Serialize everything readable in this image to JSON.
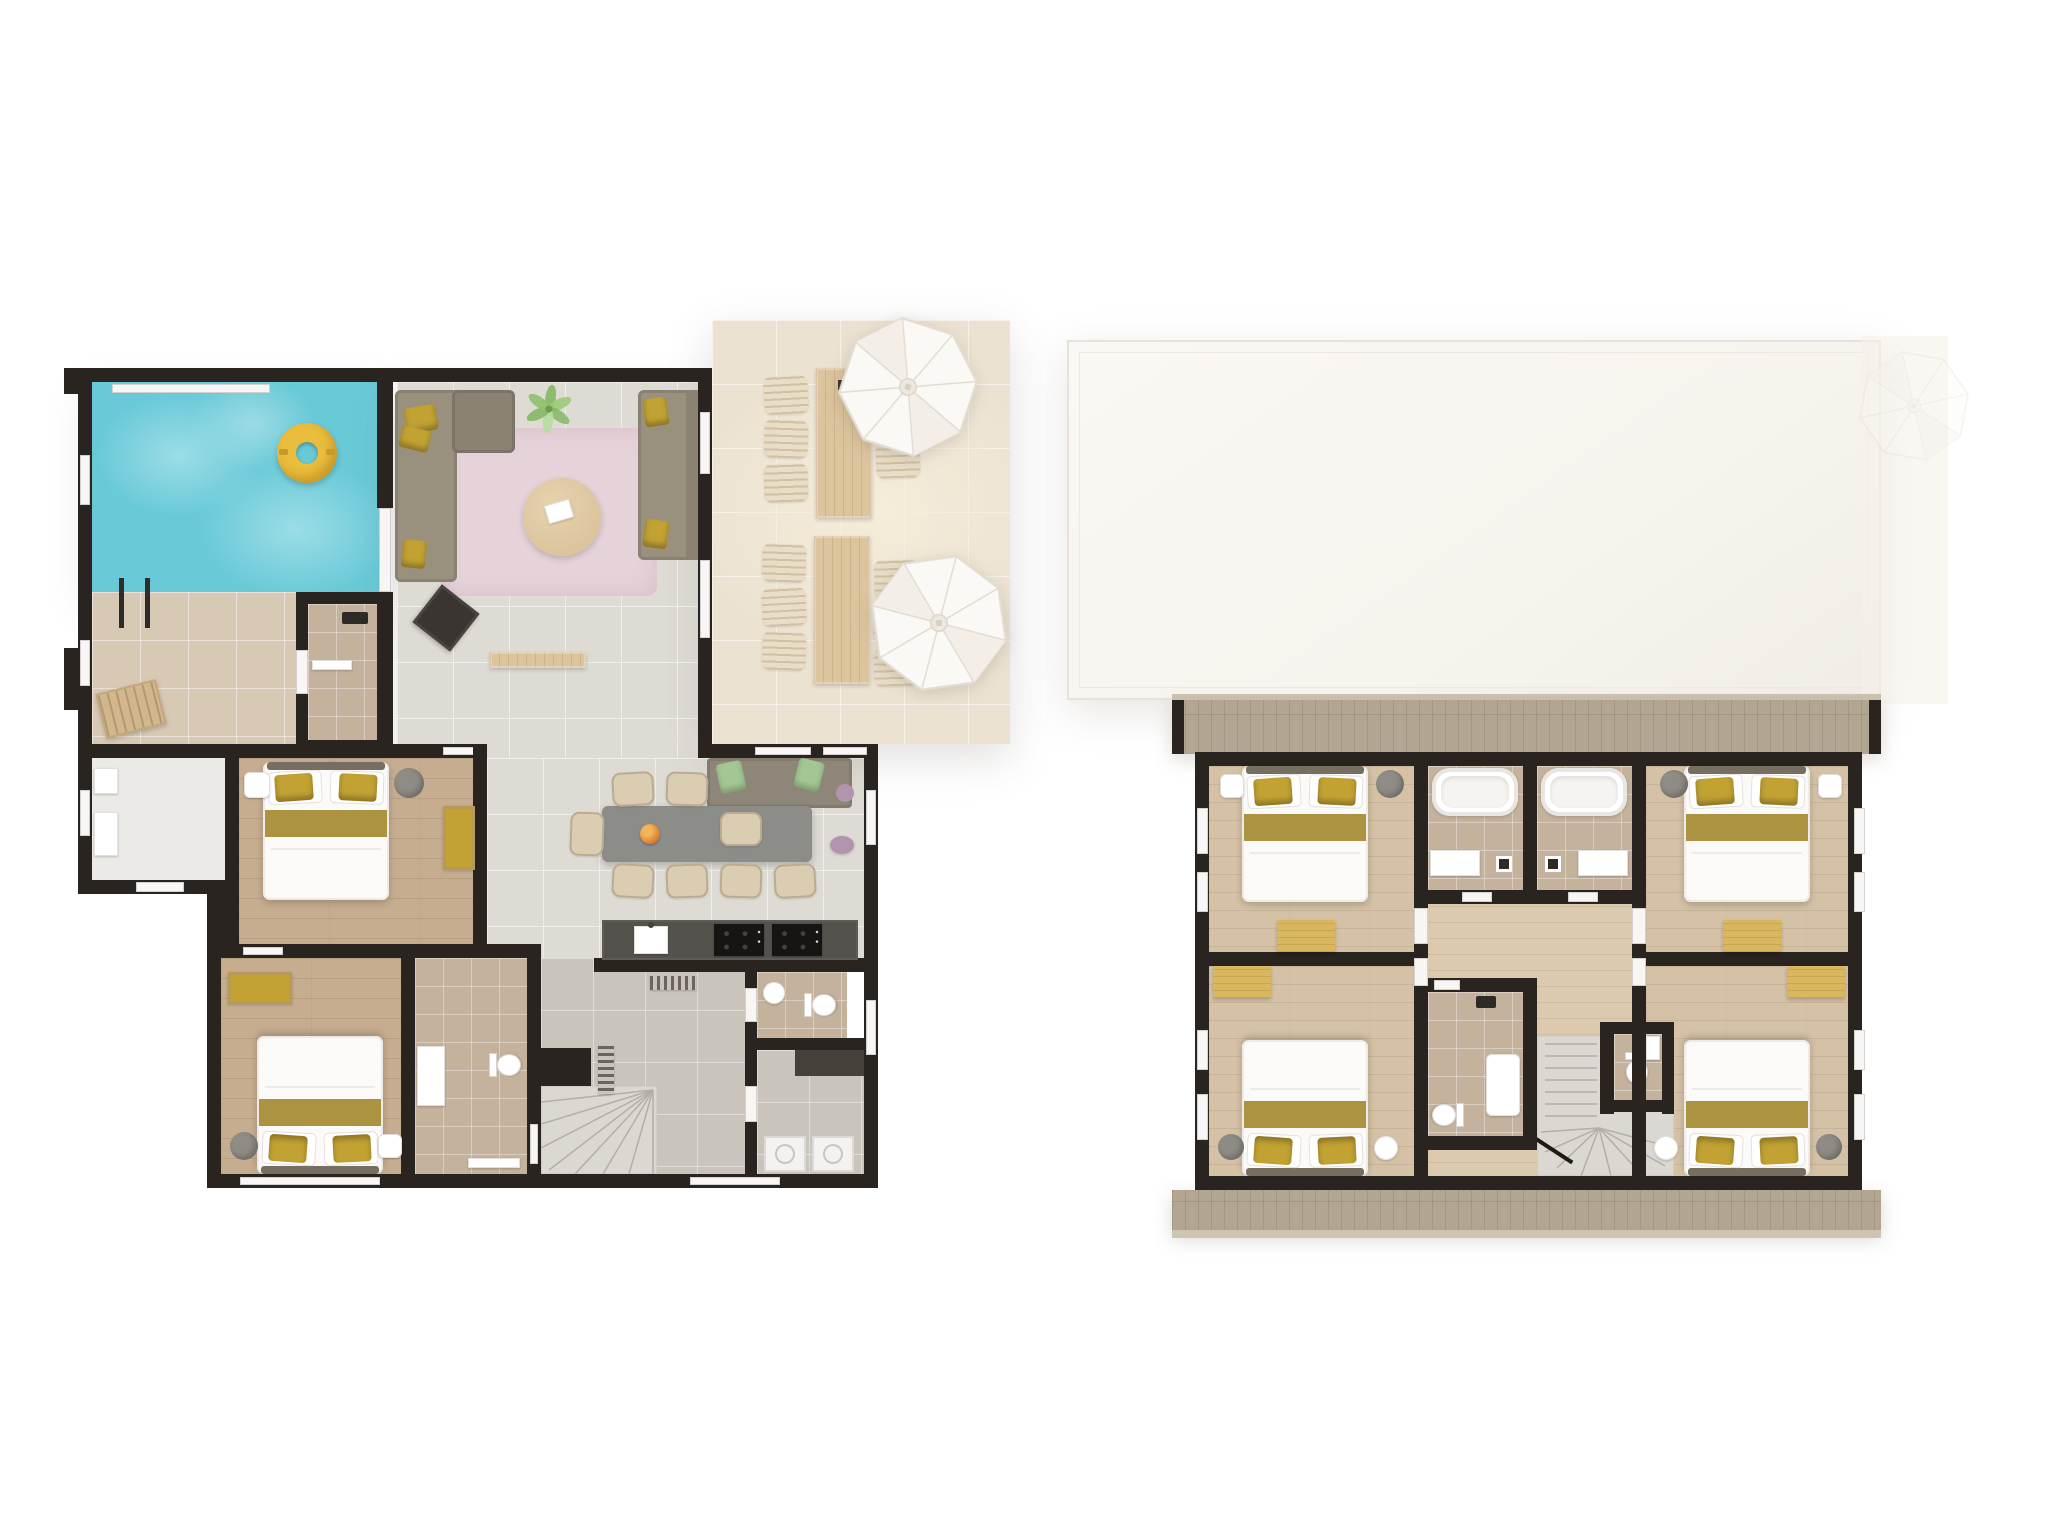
{
  "document": {
    "kind": "architectural floor plan rendering",
    "view": "top-down 3d render",
    "floor_count": 2,
    "background": "#ffffff"
  },
  "palette": {
    "bg": "#ffffff",
    "wall": "#2a2420",
    "window": "#f7f6f4",
    "pool": "#68c9d7",
    "pool-light": "#9bdde6",
    "deck-tile": "#d8c9b5",
    "tile": "#dedbd4",
    "hall-tile": "#c9c4bc",
    "terrace": "#ece2d2",
    "terrace-light": "#f6ecda",
    "wood": "#c7ad90",
    "wood-upper": "#d5c2a6",
    "wood-hall": "#dccaaf",
    "bath": "#c4b29d",
    "rug": "#e6d3da",
    "sofa": "#99907e",
    "sofa-dark": "#8b8273",
    "pillow": "#c2a233",
    "green-pillow": "#a3c794",
    "purple": "#b394ae",
    "table-wood": "#dcc49c",
    "desk": "#d9b75f",
    "chair": "#dacdb2",
    "counter": "#55524d",
    "cooktop": "#161514",
    "bed": "#fbfaf9",
    "bed-band": "#a78d38",
    "headboard": "#776e62",
    "roof": "#f7f4ee",
    "roof-line": "#e7e2da",
    "deck-band": "#b2a591",
    "deck-band-light": "#cdc4b1",
    "stair": "#dbd7d1",
    "stair-line": "#b3afa8",
    "swim-ring": "#eabe3c",
    "appliance": "#f3f2f0",
    "closet-dark": "#45403a",
    "gray-object": "#8f8b85",
    "umbrella": "#fbf9f6",
    "umbrella-seam": "#e2dcd2",
    "plant-green": "#7fb55e",
    "flower-orange": "#e08a35",
    "lounger-wood": "#d2b78d",
    "black-object": "#3a3531"
  },
  "ground_floor": {
    "label": "ground floor",
    "rooms": [
      {
        "name": "pool terrace",
        "features": [
          "swimming pool",
          "pool ladder",
          "yellow swim ring",
          "tiled pool deck",
          "wooden lounger",
          "glass sliding door"
        ]
      },
      {
        "name": "living room",
        "features": [
          "l-shaped sofa",
          "three-seat sofa",
          "pink rug",
          "round wooden coffee table",
          "magazine",
          "potted plant",
          "black side stool",
          "low wooden bench",
          "yellow cushions"
        ]
      },
      {
        "name": "outdoor dining terrace",
        "features": [
          "two long wooden tables",
          "twelve slatted terrace chairs",
          "two white parasols",
          "dark serving tray"
        ]
      },
      {
        "name": "kitchen / dining",
        "features": [
          "long grey dining table",
          "eight dining chairs",
          "window banquette with green cushions",
          "purple poufs",
          "orange flower centerpiece",
          "kitchen counter with sink",
          "two black cooktops",
          "striped floor mat"
        ]
      },
      {
        "name": "entry hall",
        "features": [
          "white floor",
          "two wall shelves",
          "entrance door opening"
        ]
      },
      {
        "name": "bedroom 1",
        "features": [
          "double bed with yellow pillows",
          "round night stand",
          "white clock tray",
          "bench with yellow cushion"
        ]
      },
      {
        "name": "bedroom 2",
        "features": [
          "double bed with yellow pillows",
          "bench with yellow cushion",
          "round night stand",
          "white side table"
        ]
      },
      {
        "name": "bathroom",
        "features": [
          "washbasin cabinet",
          "toilet",
          "white bath mat"
        ]
      },
      {
        "name": "shower room",
        "features": [
          "shower fixture",
          "white shower mat"
        ]
      },
      {
        "name": "toilet room",
        "features": [
          "round washbasin",
          "toilet"
        ]
      },
      {
        "name": "utility room",
        "features": [
          "washing machine",
          "dryer",
          "dark storage closet"
        ]
      },
      {
        "name": "staircase",
        "features": [
          "quarter-turn winder stairs",
          "wall radiator"
        ]
      }
    ]
  },
  "first_floor": {
    "label": "first floor",
    "rooms": [
      {
        "name": "roof",
        "features": [
          "large flat white roof",
          "faint neighbouring roof and parasol outline"
        ]
      },
      {
        "name": "front balcony",
        "features": [
          "plank decking band"
        ]
      },
      {
        "name": "rear balcony",
        "features": [
          "plank decking band"
        ]
      },
      {
        "name": "bedroom 3",
        "features": [
          "double bed with yellow pillows",
          "round night stand",
          "white clock tray",
          "yellow desk"
        ]
      },
      {
        "name": "bedroom 4",
        "features": [
          "double bed with yellow pillows",
          "round night stand",
          "white clock tray",
          "yellow desk"
        ]
      },
      {
        "name": "bedroom 5",
        "features": [
          "double bed with yellow pillows",
          "round night stand",
          "white side table",
          "yellow desk"
        ]
      },
      {
        "name": "bedroom 6",
        "features": [
          "double bed with yellow pillows",
          "round night stand",
          "white side table",
          "yellow desk"
        ]
      },
      {
        "name": "bathroom a",
        "features": [
          "bathtub",
          "wall-hung washbasin",
          "shower fixture"
        ]
      },
      {
        "name": "bathroom b",
        "features": [
          "bathtub",
          "wall-hung washbasin",
          "shower fixture"
        ]
      },
      {
        "name": "shower room",
        "features": [
          "shower tray",
          "toilet",
          "shower fixture"
        ]
      },
      {
        "name": "toilet room",
        "features": [
          "toilet",
          "small washbasin"
        ]
      },
      {
        "name": "landing",
        "features": [
          "wood plank floor"
        ]
      },
      {
        "name": "staircase",
        "features": [
          "straight flight",
          "winder turn",
          "handrail"
        ]
      }
    ]
  }
}
